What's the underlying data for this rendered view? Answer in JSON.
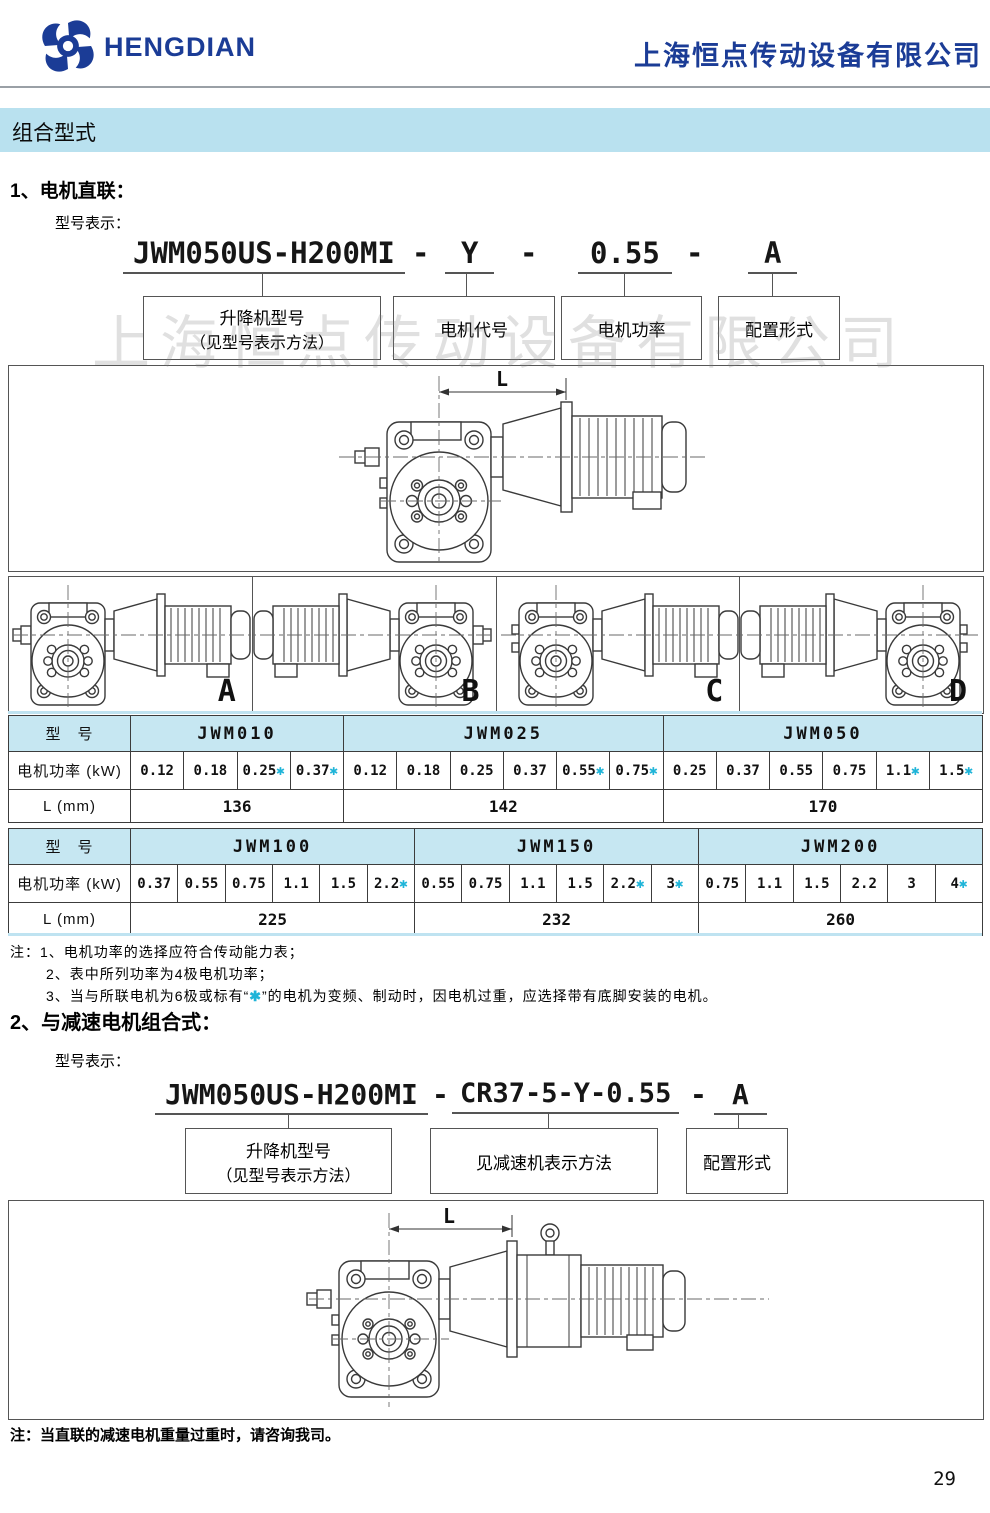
{
  "dash": "-",
  "header": {
    "logo_text": "HENGDIAN",
    "company_name": "上海恒点传动设备有限公司"
  },
  "banner": {
    "title": "组合型式"
  },
  "watermark": "上海恒点传动设备有限公司",
  "colors": {
    "brand_blue": "#1b3c96",
    "banner_bg": "#b9e1ef",
    "table_header_bg": "#c6e7f2",
    "star_cyan": "#1fb4d8"
  },
  "section1": {
    "heading": "1、电机直联：",
    "model_label": "型号表示：",
    "code_parts": [
      "JWM050US-H200MI",
      "Y",
      "0.55",
      "A"
    ],
    "boxes": [
      {
        "line1": "升降机型号",
        "line2": "（见型号表示方法）"
      },
      {
        "line1": "电机代号",
        "line2": ""
      },
      {
        "line1": "电机功率",
        "line2": ""
      },
      {
        "line1": "配置形式",
        "line2": ""
      }
    ],
    "dimension_label": "L",
    "config_labels": [
      "A",
      "B",
      "C",
      "D"
    ]
  },
  "tables": [
    {
      "model_header": "型　号",
      "power_label": "电机功率 (kW)",
      "length_label": "L (mm)",
      "groups": [
        {
          "model": "JWM010",
          "length": "136",
          "powers": [
            {
              "v": "0.12"
            },
            {
              "v": "0.18"
            },
            {
              "v": "0.25",
              "star": "✱"
            },
            {
              "v": "0.37",
              "star": "✱"
            }
          ]
        },
        {
          "model": "JWM025",
          "length": "142",
          "powers": [
            {
              "v": "0.12"
            },
            {
              "v": "0.18"
            },
            {
              "v": "0.25"
            },
            {
              "v": "0.37"
            },
            {
              "v": "0.55",
              "star": "✱"
            },
            {
              "v": "0.75",
              "star": "✱"
            }
          ]
        },
        {
          "model": "JWM050",
          "length": "170",
          "powers": [
            {
              "v": "0.25"
            },
            {
              "v": "0.37"
            },
            {
              "v": "0.55"
            },
            {
              "v": "0.75"
            },
            {
              "v": "1.1",
              "star": "✱"
            },
            {
              "v": "1.5",
              "star": "✱"
            }
          ]
        }
      ]
    },
    {
      "model_header": "型　号",
      "power_label": "电机功率 (kW)",
      "length_label": "L (mm)",
      "groups": [
        {
          "model": "JWM100",
          "length": "225",
          "powers": [
            {
              "v": "0.37"
            },
            {
              "v": "0.55"
            },
            {
              "v": "0.75"
            },
            {
              "v": "1.1"
            },
            {
              "v": "1.5"
            },
            {
              "v": "2.2",
              "star": "✱"
            }
          ]
        },
        {
          "model": "JWM150",
          "length": "232",
          "powers": [
            {
              "v": "0.55"
            },
            {
              "v": "0.75"
            },
            {
              "v": "1.1"
            },
            {
              "v": "1.5"
            },
            {
              "v": "2.2",
              "star": "✱"
            },
            {
              "v": "3",
              "star": "✱"
            }
          ]
        },
        {
          "model": "JWM200",
          "length": "260",
          "powers": [
            {
              "v": "0.75"
            },
            {
              "v": "1.1"
            },
            {
              "v": "1.5"
            },
            {
              "v": "2.2"
            },
            {
              "v": "3"
            },
            {
              "v": "4",
              "star": "✱"
            }
          ]
        }
      ]
    }
  ],
  "notes": {
    "line1": "注：1、电机功率的选择应符合传动能力表；",
    "line2": "2、表中所列功率为4极电机功率；",
    "line3_pre": "3、当与所联电机为6极或标有“",
    "line3_star": "✱",
    "line3_post": "”的电机为变频、制动时，因电机过重，应选择带有底脚安装的电机。"
  },
  "section2": {
    "heading": "2、与减速电机组合式：",
    "model_label": "型号表示：",
    "code_parts": [
      "JWM050US-H200MI",
      "CR37-5-Y-0.55",
      "A"
    ],
    "boxes": [
      {
        "line1": "升降机型号",
        "line2": "（见型号表示方法）"
      },
      {
        "line1": "见减速机表示方法",
        "line2": ""
      },
      {
        "line1": "配置形式",
        "line2": ""
      }
    ],
    "dimension_label": "L",
    "note": "注：当直联的减速电机重量过重时，请咨询我司。"
  },
  "page": {
    "number": "29"
  }
}
